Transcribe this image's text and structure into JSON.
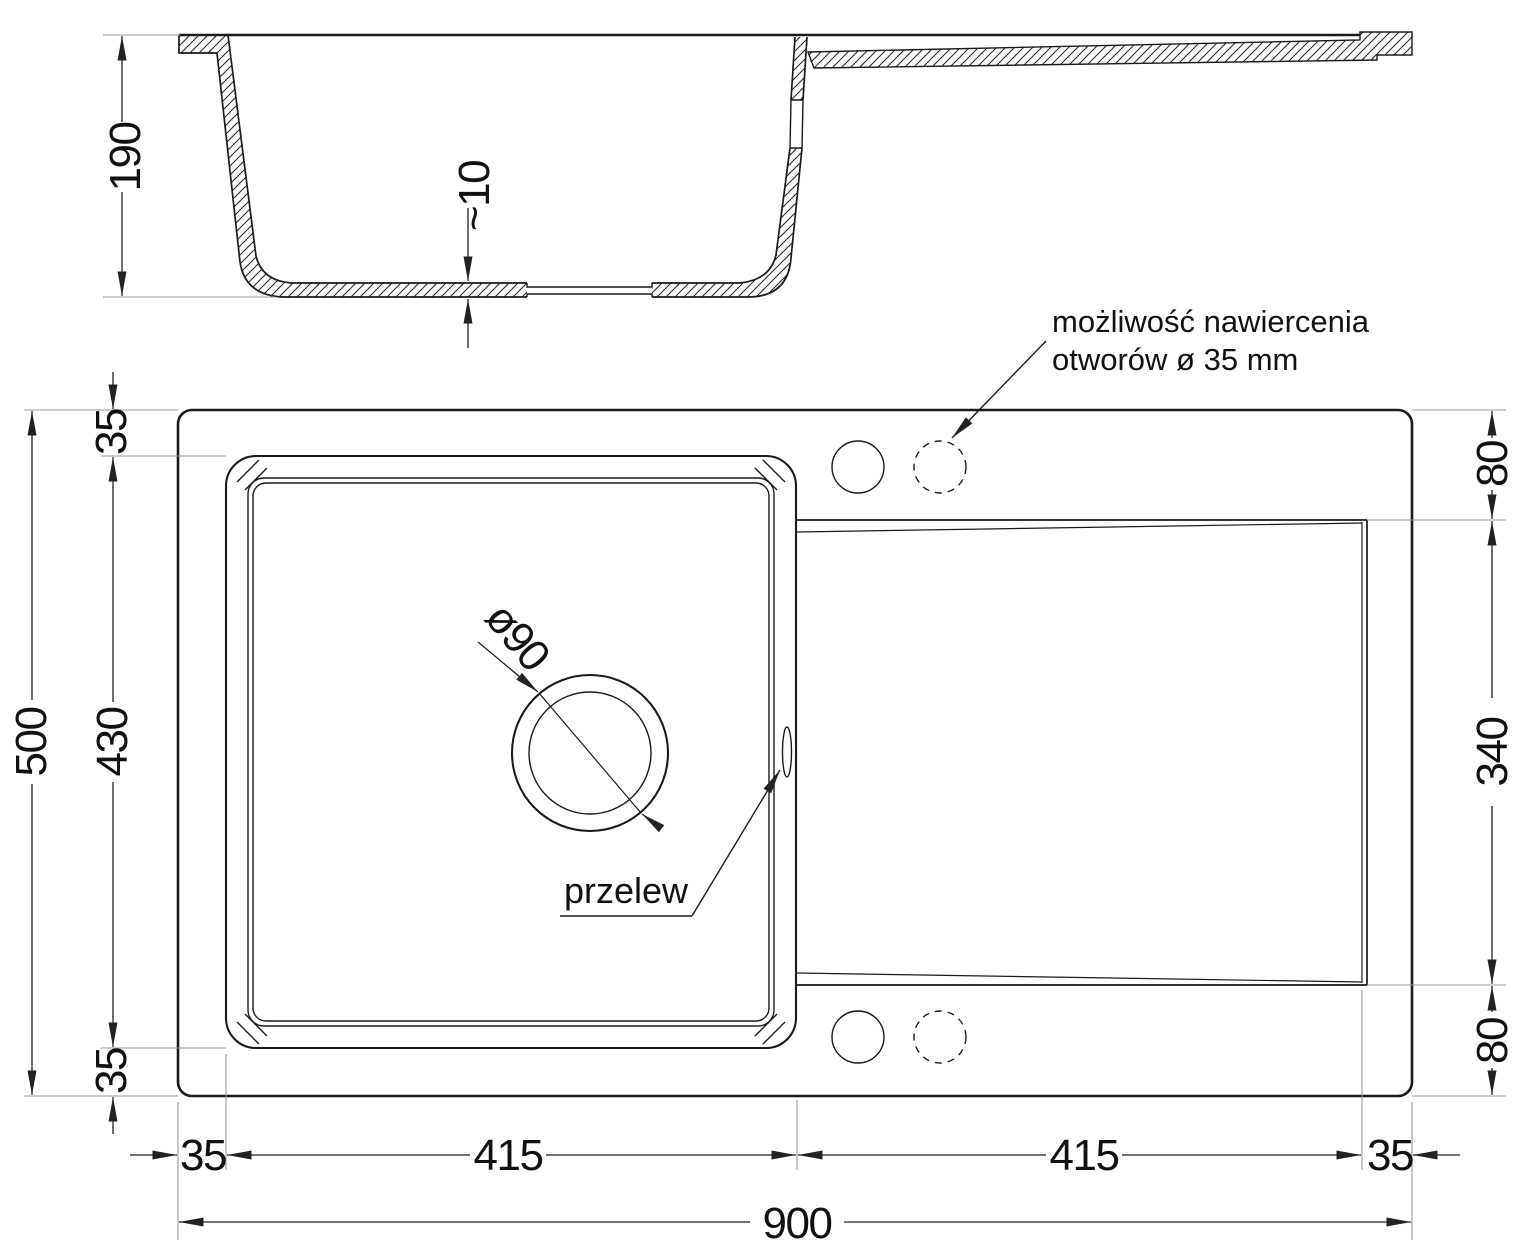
{
  "meta": {
    "background": "#ffffff",
    "ink_color": "#1a1a1a",
    "drawing_type": "technical drawing - kitchen sink with drainboard"
  },
  "section_view": {
    "depth": "190",
    "bottom_thickness": "~10"
  },
  "plan_view": {
    "overall_width": "900",
    "overall_depth": "500",
    "bowl_depth": "430",
    "bowl_width": "415",
    "drainer_width": "415",
    "margin_top": "35",
    "margin_bottom": "35",
    "margin_left": "35",
    "margin_right": "35",
    "drainer_top_offset": "80",
    "drainer_length": "340",
    "drainer_bottom_offset": "80",
    "drain_diameter": "ø90",
    "overflow_label": "przelew",
    "drill_note_line1": "możliwość nawiercenia",
    "drill_note_line2": "otworów ø 35 mm"
  }
}
